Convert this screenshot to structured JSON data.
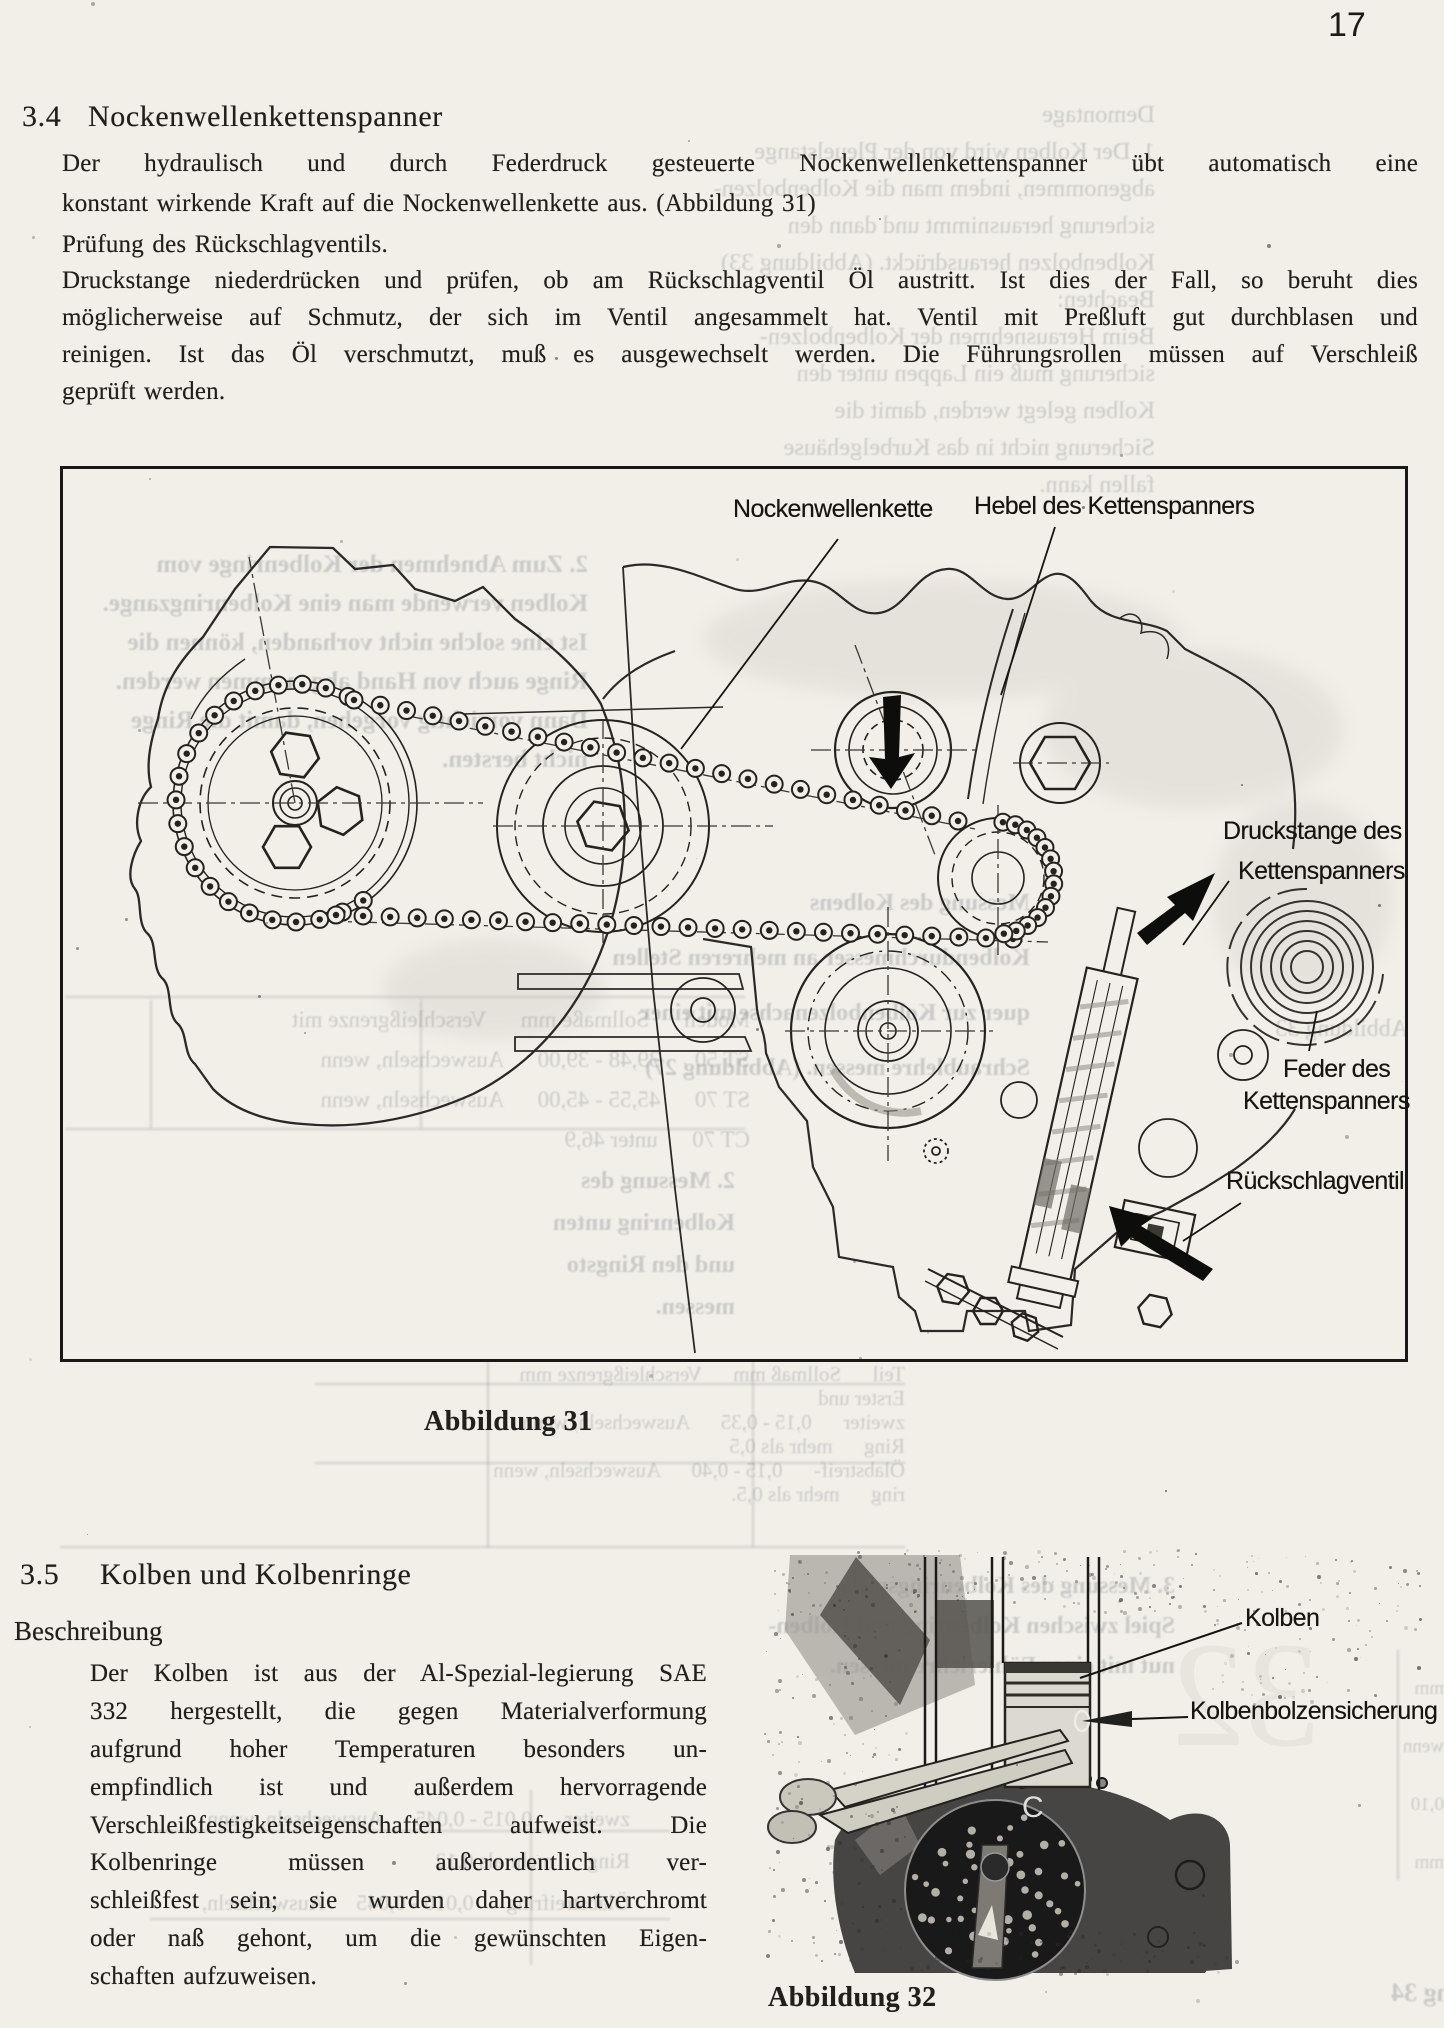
{
  "page_number": "17",
  "section_34": {
    "number": "3.4",
    "title": "Nockenwellenkettenspanner",
    "para1": [
      "Der hydraulisch und durch Federdruck gesteuerte Nockenwellenkettenspanner übt automatisch eine",
      "konstant wirkende Kraft auf die Nockenwellenkette aus.  (Abbildung 31)"
    ],
    "subheading": "Prüfung des Rückschlagventils.",
    "para2": [
      "Druckstange niederdrücken und prüfen, ob am Rückschlagventil Öl austritt. Ist dies der Fall, so beruht dies",
      "möglicherweise auf Schmutz, der sich im Ventil angesammelt hat. Ventil mit Preßluft gut durchblasen und",
      "reinigen. Ist das Öl verschmutzt, muß es ausgewechselt werden. Die Führungsrollen müssen auf Verschleiß",
      "geprüft werden."
    ]
  },
  "figure31": {
    "caption": "Abbildung 31",
    "labels": {
      "chain": "Nockenwellenkette",
      "lever": "Hebel des Kettenspanners",
      "pushrod_1": "Druckstange des",
      "pushrod_2": "Kettenspanners",
      "spring_1": "Feder des",
      "spring_2": "Kettenspanners",
      "check_valve": "Rückschlagventil"
    }
  },
  "section_35": {
    "number": "3.5",
    "title": "Kolben und Kolbenringe",
    "subheading": "Beschreibung",
    "para": [
      "Der Kolben ist aus der Al-Spezial-legierung SAE",
      "332 hergestellt, die gegen Materialverformung",
      "aufgrund hoher Temperaturen besonders un-",
      "empfindlich ist und außerdem hervorragende",
      "Verschleißfestigkeitseigenschaften aufweist. Die",
      "Kolbenringe müssen außerordentlich ver-",
      "schleißfest sein; sie wurden daher hartverchromt",
      "oder naß gehont, um die gewünschten Eigen-",
      "schaften aufzuweisen."
    ]
  },
  "figure32": {
    "caption": "Abbildung 32",
    "stamp_letter": "C",
    "labels": {
      "piston": "Kolben",
      "pin_clip": "Kolbenbolzensicherung"
    }
  },
  "ghost": {
    "groups": [
      {
        "lines": [
          "Demontage",
          "1. Der Kolben wird von der Pleuelstange",
          "abgenommen, indem man die Kolbenbolzen-",
          "sicherung herausnimmt und dann den",
          "Kolbenbolzen herausdrückt. (Abbildung 33)",
          "Beachten:",
          "Beim Herausnehmen der Kolbenbolzen-",
          "sicherung muß ein Lappen unter den",
          "Kolben gelegt werden, damit die",
          "Sicherung nicht in das Kurbelgehäuse",
          "fallen kann."
        ]
      },
      {
        "lines": [
          "2. Zum Abnehmen der Kolbenringe vom",
          "Kolben verwende man eine Kolbenringzange.",
          "Ist eine solche nicht vorhanden, können die",
          "Ringe auch von Hand abgenommen werden.",
          "Dann vorsichtig vorgehen, damit die Ringe",
          "nicht bersten."
        ]
      },
      {
        "lines": [
          "Messung des Kolbens",
          "Kolbendurchmesser an mehreren Stellen",
          "quer zur Kolbenbolzenachse mit einer",
          "Schraublehre messen. (Abbildung 27)"
        ]
      },
      {
        "lines": [
          "Modell      Sollmaße mm      Verschleißgrenze mit",
          "ST 50      39,48 - 39,00      Auswechseln, wenn",
          "ST 70      45,55 - 45,00      Auswechseln, wenn",
          "CT 70      unter 46,9"
        ]
      },
      {
        "lines": [
          "2. Messung des",
          "Kolbenring unten",
          "und den Ringsto",
          "messen."
        ]
      },
      {
        "lines": [
          "Teil      Sollmaß mm      Verschleißgrenze mm",
          "Erster und",
          "zweiter      0,15 - 0,35      Auswechseln, wenn",
          "Ring      mehr als 0,5",
          "Ölabstreif-      0,15 - 0,40      Auswechseln, wenn",
          "ring      mehr als 0,5."
        ]
      },
      {
        "lines": [
          "3. Messung des Kolbenringspiels.",
          "Spiel zwischen Kolbenring und Kolben-",
          "nut mit einer Fühlerlehre messen."
        ]
      },
      {
        "lines": [
          "zweiter      0,015 - 0,045      Auswechseln, wenn",
          "Ring      mehr als 0,12",
          "Ölabstreifring      0,010 - 0,045      Auswechseln,"
        ]
      },
      {
        "lines": [
          "Abbildung 33"
        ]
      },
      {
        "lines": [
          "Abbildung 34"
        ]
      },
      {
        "lines": [
          "mm",
          "wenn",
          "0,10",
          "mm"
        ]
      }
    ]
  }
}
